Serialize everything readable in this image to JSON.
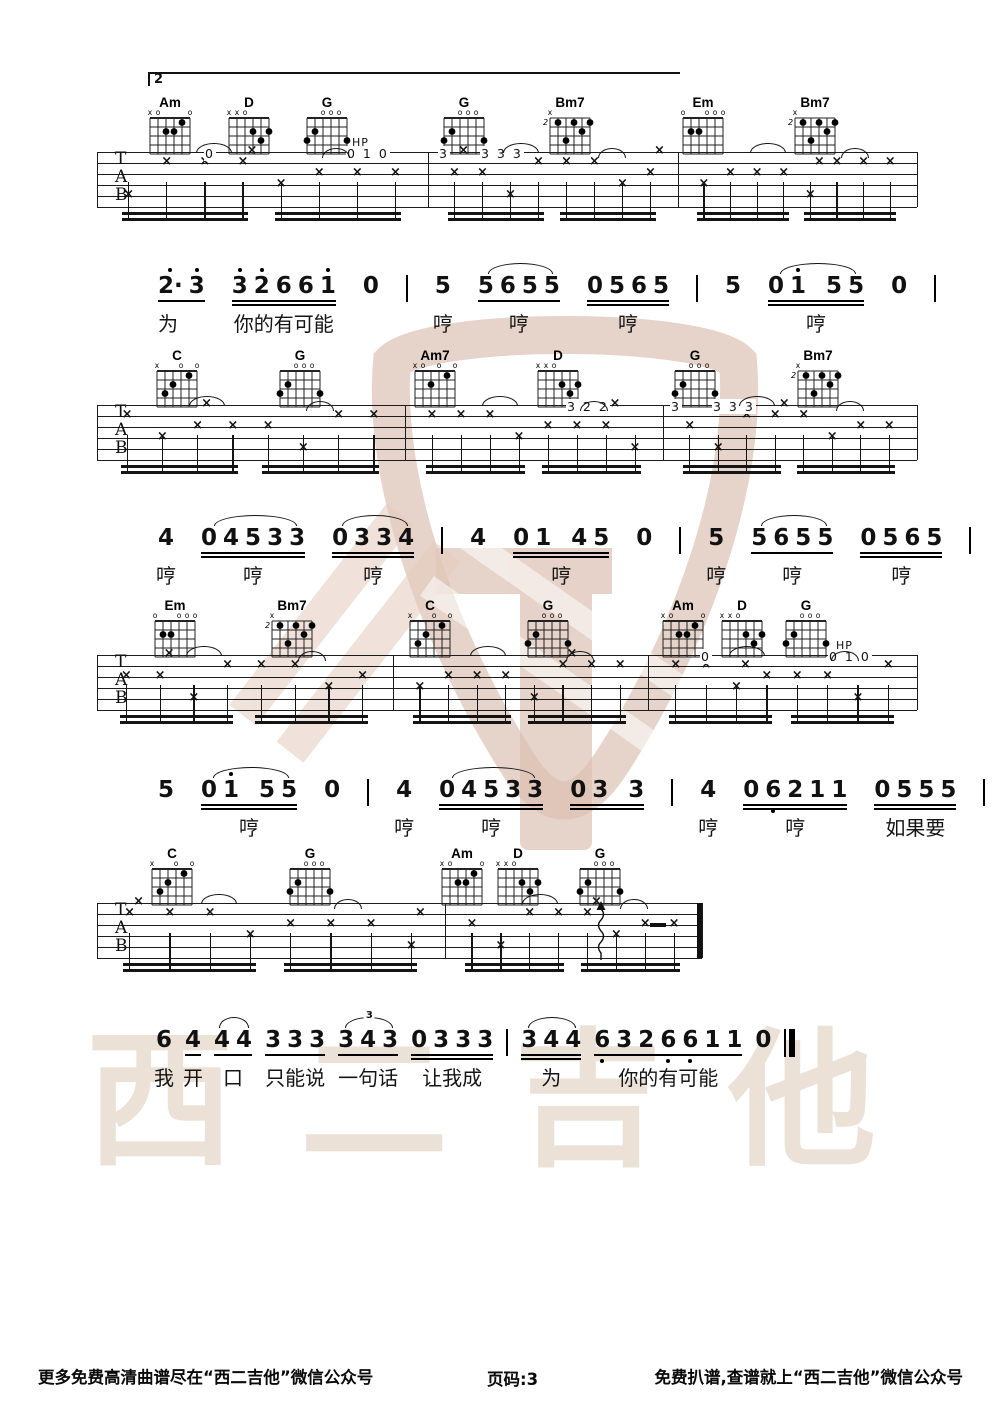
{
  "page": {
    "watermark_text": "西二吉他",
    "volta": "2"
  },
  "footer": {
    "left": "更多免费高清曲谱尽在“西二吉他”微信公众号",
    "center": "页码:3",
    "right": "免费扒谱,查谱就上“西二吉他”微信公众号"
  },
  "chord_shapes": {
    "Am": {
      "markers": [
        "x",
        "o",
        "",
        "",
        "",
        "o"
      ],
      "dots": [
        [
          3,
          2
        ],
        [
          4,
          2
        ],
        [
          5,
          1
        ]
      ],
      "pos": ""
    },
    "Am7": {
      "markers": [
        "x",
        "o",
        "",
        "o",
        "",
        "o"
      ],
      "dots": [
        [
          3,
          2
        ],
        [
          5,
          1
        ]
      ],
      "pos": ""
    },
    "D": {
      "markers": [
        "x",
        "x",
        "o",
        "",
        "",
        ""
      ],
      "dots": [
        [
          4,
          2
        ],
        [
          6,
          2
        ],
        [
          5,
          3
        ]
      ],
      "pos": ""
    },
    "G": {
      "markers": [
        "",
        "",
        "o",
        "o",
        "o",
        ""
      ],
      "dots": [
        [
          1,
          3
        ],
        [
          2,
          2
        ],
        [
          6,
          3
        ]
      ],
      "pos": ""
    },
    "C": {
      "markers": [
        "x",
        "",
        "",
        "o",
        "",
        "o"
      ],
      "dots": [
        [
          2,
          3
        ],
        [
          3,
          2
        ],
        [
          5,
          1
        ]
      ],
      "pos": ""
    },
    "Em": {
      "markers": [
        "o",
        "",
        "",
        "o",
        "o",
        "o"
      ],
      "dots": [
        [
          2,
          2
        ],
        [
          3,
          2
        ]
      ],
      "pos": ""
    },
    "Bm7": {
      "markers": [
        "x",
        "",
        "",
        "",
        "",
        ""
      ],
      "dots": [
        [
          2,
          1
        ],
        [
          4,
          1
        ],
        [
          6,
          1
        ],
        [
          5,
          2
        ],
        [
          3,
          3
        ]
      ],
      "pos": "2"
    }
  },
  "systems": [
    {
      "top": 152,
      "bars": [
        97,
        428,
        678,
        917
      ],
      "chords": [
        {
          "name": "Am",
          "x": 170
        },
        {
          "name": "D",
          "x": 249
        },
        {
          "name": "G",
          "x": 327
        },
        {
          "name": "G",
          "x": 464
        },
        {
          "name": "Bm7",
          "x": 570
        },
        {
          "name": "Em",
          "x": 703
        },
        {
          "name": "Bm7",
          "x": 815
        }
      ],
      "texts": [
        {
          "t": "0",
          "x": 204
        },
        {
          "t": "0 1 0",
          "x": 346
        },
        {
          "t": "HP",
          "x": 352,
          "hp": 1
        },
        {
          "t": "3",
          "x": 438
        },
        {
          "t": "3 3 3",
          "x": 480
        }
      ]
    },
    {
      "top": 405,
      "bars": [
        97,
        405,
        663,
        917
      ],
      "chords": [
        {
          "name": "C",
          "x": 177
        },
        {
          "name": "G",
          "x": 300
        },
        {
          "name": "Am7",
          "x": 435
        },
        {
          "name": "D",
          "x": 558
        },
        {
          "name": "G",
          "x": 695
        },
        {
          "name": "Bm7",
          "x": 818
        }
      ],
      "texts": [
        {
          "t": "3 2 2",
          "x": 566
        },
        {
          "t": "3",
          "x": 670
        },
        {
          "t": "3 3 3",
          "x": 712
        }
      ]
    },
    {
      "top": 655,
      "bars": [
        97,
        393,
        648,
        917
      ],
      "chords": [
        {
          "name": "Em",
          "x": 175
        },
        {
          "name": "Bm7",
          "x": 292
        },
        {
          "name": "C",
          "x": 430
        },
        {
          "name": "G",
          "x": 548
        },
        {
          "name": "Am",
          "x": 683
        },
        {
          "name": "D",
          "x": 742
        },
        {
          "name": "G",
          "x": 806
        }
      ],
      "texts": [
        {
          "t": "0",
          "x": 700
        },
        {
          "t": "0 1 0",
          "x": 828
        },
        {
          "t": "HP",
          "x": 836,
          "hp": 1
        }
      ]
    },
    {
      "top": 903,
      "bars": [
        97,
        445,
        702
      ],
      "chords": [
        {
          "name": "C",
          "x": 172
        },
        {
          "name": "G",
          "x": 310
        },
        {
          "name": "Am",
          "x": 462
        },
        {
          "name": "D",
          "x": 518
        },
        {
          "name": "G",
          "x": 600
        }
      ],
      "texts": [],
      "ending": true,
      "squiggle": 601,
      "rest": 650
    }
  ],
  "jianpu_lines": [
    {
      "left": 158,
      "top": 262,
      "groups": [
        {
          "notes": "2'· 3'",
          "ul": 1,
          "lyric": "为",
          "la": "l"
        },
        {
          "notes": "3' 2' 6 6 1'",
          "ul": 2,
          "lyric": "你的有可能"
        },
        {
          "notes": "0"
        },
        {
          "bar": 1
        },
        {
          "notes": "5",
          "lyric": "哼"
        },
        {
          "notes": "5 6 5 5",
          "ul": 1,
          "slur": 1,
          "lyric": "哼"
        },
        {
          "notes": "0 5 6 5",
          "ul": 2,
          "lyric": "哼"
        },
        {
          "bar": 1
        },
        {
          "notes": "5"
        },
        {
          "notes": "0 1' _ 5 5",
          "ul": 2,
          "slur": 1,
          "lyric": "哼"
        },
        {
          "notes": "0"
        },
        {
          "bar": 1
        }
      ]
    },
    {
      "left": 158,
      "top": 514,
      "groups": [
        {
          "notes": "4",
          "lyric": "哼"
        },
        {
          "notes": "0 4 5 3 3",
          "ul": 2,
          "slur": 1,
          "lyric": "哼"
        },
        {
          "notes": "0 3 3 4",
          "ul": 2,
          "slur": 1,
          "lyric": "哼"
        },
        {
          "bar": 1
        },
        {
          "notes": "4"
        },
        {
          "notes": "0 1 _ 4 5",
          "ul": 2,
          "lyric": "哼"
        },
        {
          "notes": "0"
        },
        {
          "bar": 1
        },
        {
          "notes": "5",
          "lyric": "哼"
        },
        {
          "notes": "5 6 5 5",
          "ul": 1,
          "slur": 1,
          "lyric": "哼"
        },
        {
          "notes": "0 5 6 5",
          "ul": 2,
          "lyric": "哼"
        },
        {
          "bar": 1
        }
      ]
    },
    {
      "left": 158,
      "top": 766,
      "groups": [
        {
          "notes": "5"
        },
        {
          "notes": "0 1' _ 5 5",
          "ul": 2,
          "slur": 1,
          "lyric": "哼"
        },
        {
          "notes": "0"
        },
        {
          "bar": 1
        },
        {
          "notes": "4",
          "lyric": "哼"
        },
        {
          "notes": "0 4 5 3 3",
          "ul": 2,
          "slur": 1,
          "lyric": "哼"
        },
        {
          "notes": "0 3 _ 3",
          "ul": 2
        },
        {
          "bar": 1
        },
        {
          "notes": "4",
          "lyric": "哼"
        },
        {
          "notes": "0 6, 2 1 1",
          "ul": 2,
          "lyric": "哼"
        },
        {
          "notes": "0 5 5 5",
          "ul": 2,
          "lyric": "如果要"
        },
        {
          "bar": 1
        }
      ]
    },
    {
      "left": 156,
      "top": 1016,
      "groups": [
        {
          "notes": "6",
          "lyric": "我"
        },
        {
          "notes": "4",
          "ul": 1,
          "lyric": "开"
        },
        {
          "notes": "4 4",
          "ul": 1,
          "slur": 1,
          "lyric": "口"
        },
        {
          "notes": "3 3 3",
          "ul": 1,
          "lyric": "只能说"
        },
        {
          "notes": "3 4 3",
          "ul": 1,
          "slur": 1,
          "tuplet": "3",
          "lyric": "一句话"
        },
        {
          "notes": "0 3 3 3",
          "ul": 2,
          "lyric": "让我成"
        },
        {
          "bar": 1
        },
        {
          "notes": "3 4 4",
          "ul": 2,
          "slur": 1,
          "lyric": "为"
        },
        {
          "notes": "6, 3 2 6, 6, 1 1",
          "ul": 1,
          "lyric": "你的有可能"
        },
        {
          "notes": "0"
        },
        {
          "bar": 2
        }
      ]
    }
  ]
}
